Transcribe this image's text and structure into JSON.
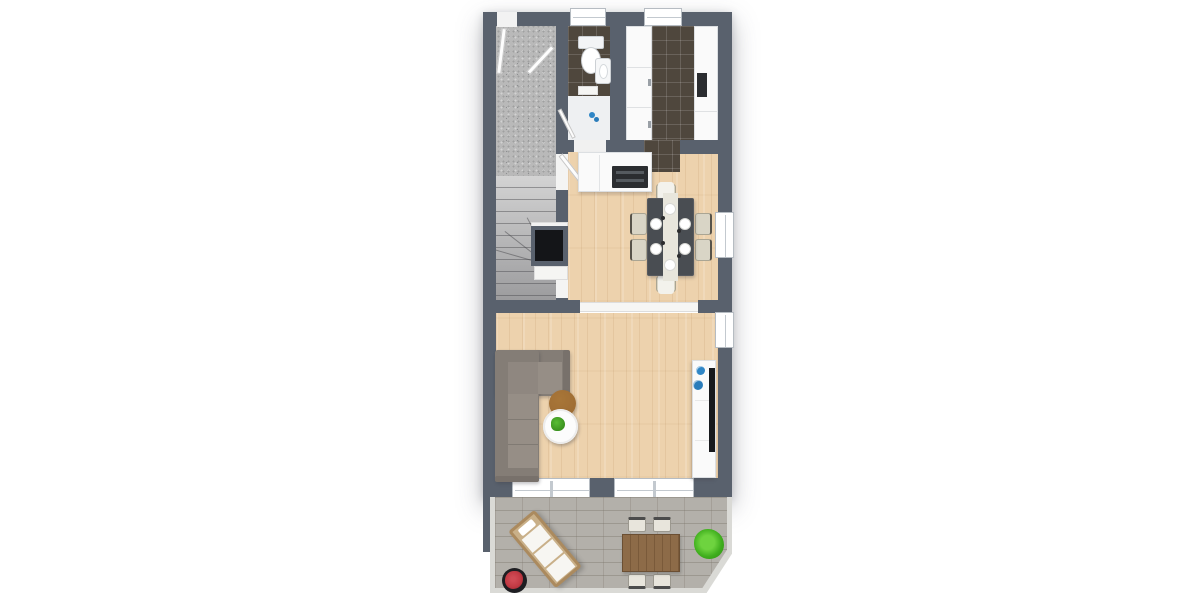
{
  "scene": {
    "type": "3d-floor-plan-top-view",
    "background": "#ffffff",
    "text_visible": "none"
  },
  "palette": {
    "wall": "#59616d",
    "wood_floor": "#edd2ad",
    "tile_dark": "#4f473d",
    "hall_floor": "#b9b9b9",
    "paver": "#b3b0aa",
    "curb": "#dadad6",
    "sofa": "#847d76",
    "sofa_seat": "#968e86",
    "ottoman": "#9c6a32",
    "dining_table": "#494d52",
    "chair_cream": "#d9d5c6",
    "wood_table": "#8a6947",
    "plant_green": "#4db32a",
    "flower_red": "#c23a44",
    "pot_black": "#1e1e22",
    "vase_blue": "#2f86c6",
    "cooktop": "#2b2d30",
    "tv": "#17191c"
  },
  "rooms": [
    {
      "id": "entry-hall",
      "floor": "speckled-gray",
      "features": [
        "entry-door-north",
        "closet-door",
        "staircase-with-winder"
      ]
    },
    {
      "id": "wc",
      "floor": "dark-brown-tile",
      "fixtures": [
        "toilet",
        "hand-basin",
        "window-north",
        "blue-accessory"
      ]
    },
    {
      "id": "kitchen",
      "floor": "dark-brown-tile",
      "fixtures": [
        "counter-run-west",
        "counter-run-east",
        "dark-appliance",
        "window-north"
      ]
    },
    {
      "id": "dining-room",
      "floor": "light-wood",
      "furniture": [
        "island-counter-with-cooktop",
        "dark-dining-table",
        "six-cream-chairs",
        "six-place-settings",
        "white-table-runner",
        "fireplace-in-west-wall",
        "white-bench"
      ]
    },
    {
      "id": "living-room",
      "floor": "light-wood",
      "furniture": [
        "corner-sofa-taupe",
        "round-brown-ottoman",
        "round-white-side-table-with-plant",
        "white-sideboard-with-tv",
        "two-blue-vases"
      ]
    },
    {
      "id": "terrace",
      "floor": "stone-pavers",
      "shape": "clipped-south-east-corner",
      "furniture": [
        "sun-lounger-diagonal",
        "black-pot-with-red-plant",
        "wooden-outdoor-table",
        "four-outdoor-chairs",
        "green-shrub"
      ]
    }
  ],
  "openings": {
    "windows": [
      "wc-north",
      "kitchen-north",
      "dining-east",
      "living-east",
      "living-south-double",
      "living-south-sliding-door"
    ],
    "doors": [
      "entry-north",
      "hall-to-wc",
      "hall-to-dining-north",
      "hall-to-dining-south",
      "kitchen-to-dining",
      "wide-opening-dining-to-living"
    ]
  }
}
